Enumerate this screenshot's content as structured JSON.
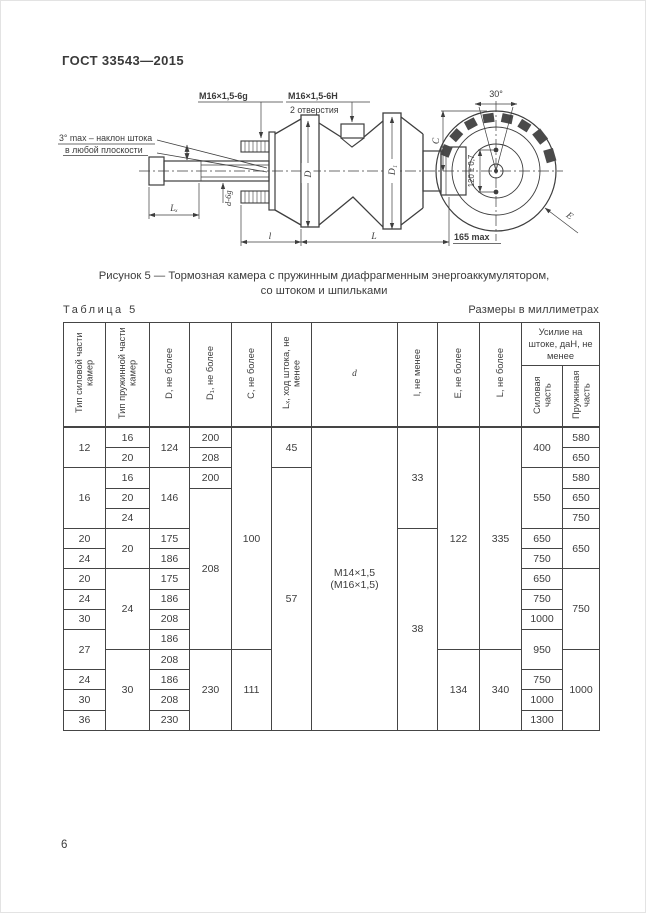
{
  "page": {
    "doc_number": "ГОСТ 33543—2015",
    "page_number": "6"
  },
  "figure": {
    "caption_line1": "Рисунок 5 — Тормозная камера с пружинным диафрагменным энергоаккумулятором,",
    "caption_line2": "со штоком и шпильками",
    "labels": {
      "rod_thread": "M16×1,5-6g",
      "holes_thread": "M16×1,5-6H",
      "holes_count": "2 отверстия",
      "tilt_line1": "3° max – наклон штока",
      "tilt_line2": "в любой плоскости",
      "rod_dia": "d-6g",
      "dim_lx": "Lₓ",
      "dim_d": "D",
      "dim_d1": "D₁",
      "dim_l_small": "l",
      "dim_l_big": "L",
      "dim_165": "165 max",
      "dim_c": "C",
      "dim_30": "30°",
      "dim_120": "120 ± 0,7",
      "dim_e": "E"
    }
  },
  "table": {
    "label": "Таблица 5",
    "units_note": "Размеры в миллиметрах",
    "col_headers": [
      "Тип силовой части камер",
      "Тип пружинной части камер",
      "D, не более",
      "D₁, не более",
      "C, не более",
      "Lₓ, ход штока, не менее",
      "d",
      "l, не менее",
      "E, не более",
      "L, не более"
    ],
    "force_group": {
      "title": "Усилие на штоке, даН, не менее",
      "sub": [
        "Силовая часть",
        "Пружинная часть"
      ]
    },
    "rows": [
      [
        {
          "t": "12",
          "rs": 2
        },
        {
          "t": "16"
        },
        {
          "t": "124",
          "rs": 2
        },
        {
          "t": "200"
        },
        {
          "t": "100",
          "rs": 11
        },
        {
          "t": "45",
          "rs": 2
        },
        {
          "t": "M14×1,5\n(M16×1,5)",
          "rs": 15
        },
        {
          "t": "33",
          "rs": 5
        },
        {
          "t": "122",
          "rs": 11
        },
        {
          "t": "335",
          "rs": 11
        },
        {
          "t": "400",
          "rs": 2
        },
        {
          "t": "580"
        }
      ],
      [
        {
          "t": "20"
        },
        {
          "t": "208"
        },
        {
          "t": "650"
        }
      ],
      [
        {
          "t": "16",
          "rs": 3
        },
        {
          "t": "16"
        },
        {
          "t": "146",
          "rs": 3
        },
        {
          "t": "200"
        },
        {
          "t": "57",
          "rs": 13
        },
        {
          "t": "550",
          "rs": 3
        },
        {
          "t": "580"
        }
      ],
      [
        {
          "t": "20"
        },
        {
          "t": "208",
          "rs": 8
        },
        {
          "t": "650"
        }
      ],
      [
        {
          "t": "24"
        },
        {
          "t": "750"
        }
      ],
      [
        {
          "t": "20"
        },
        {
          "t": "20",
          "rs": 2
        },
        {
          "t": "175"
        },
        {
          "t": "38",
          "rs": 10
        },
        {
          "t": "650"
        },
        {
          "t": "650",
          "rs": 2
        }
      ],
      [
        {
          "t": "24"
        },
        {
          "t": "186"
        },
        {
          "t": "750"
        }
      ],
      [
        {
          "t": "20"
        },
        {
          "t": "24",
          "rs": 4
        },
        {
          "t": "175"
        },
        {
          "t": "650"
        },
        {
          "t": "750",
          "rs": 4
        }
      ],
      [
        {
          "t": "24"
        },
        {
          "t": "186"
        },
        {
          "t": "750"
        }
      ],
      [
        {
          "t": "30"
        },
        {
          "t": "208"
        },
        {
          "t": "1000"
        }
      ],
      [
        {
          "t": "27",
          "rs": 2
        },
        {
          "t": "186"
        },
        {
          "t": "950",
          "rs": 2
        }
      ],
      [
        {
          "t": "30",
          "rs": 4
        },
        {
          "t": "208"
        },
        {
          "t": "230",
          "rs": 4
        },
        {
          "t": "111",
          "rs": 4
        },
        {
          "t": "134",
          "rs": 4
        },
        {
          "t": "340",
          "rs": 4
        },
        {
          "t": "1000",
          "rs": 4
        }
      ],
      [
        {
          "t": "24"
        },
        {
          "t": "186"
        },
        {
          "t": "750"
        }
      ],
      [
        {
          "t": "30"
        },
        {
          "t": "208"
        },
        {
          "t": "1000"
        }
      ],
      [
        {
          "t": "36"
        },
        {
          "t": "230"
        },
        {
          "t": "1300"
        }
      ]
    ]
  }
}
